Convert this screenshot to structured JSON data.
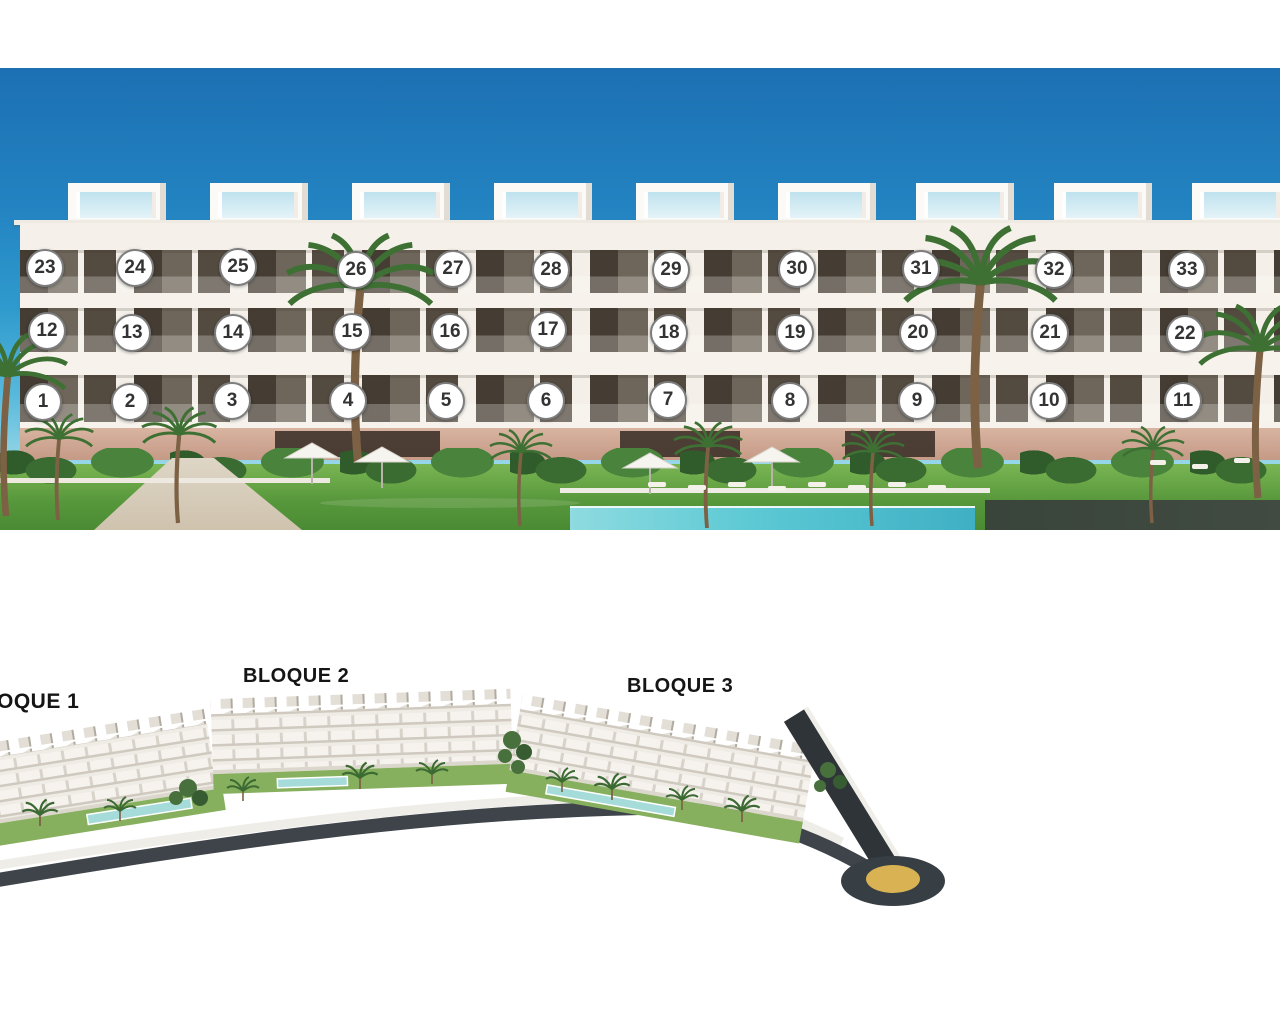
{
  "front_view": {
    "unit_markers": [
      {
        "n": "1",
        "x": 43,
        "y": 402
      },
      {
        "n": "2",
        "x": 130,
        "y": 402
      },
      {
        "n": "3",
        "x": 232,
        "y": 401
      },
      {
        "n": "4",
        "x": 348,
        "y": 401
      },
      {
        "n": "5",
        "x": 446,
        "y": 401
      },
      {
        "n": "6",
        "x": 546,
        "y": 401
      },
      {
        "n": "7",
        "x": 668,
        "y": 400
      },
      {
        "n": "8",
        "x": 790,
        "y": 401
      },
      {
        "n": "9",
        "x": 917,
        "y": 401
      },
      {
        "n": "10",
        "x": 1049,
        "y": 401
      },
      {
        "n": "11",
        "x": 1183,
        "y": 401
      },
      {
        "n": "12",
        "x": 47,
        "y": 331
      },
      {
        "n": "13",
        "x": 132,
        "y": 333
      },
      {
        "n": "14",
        "x": 233,
        "y": 333
      },
      {
        "n": "15",
        "x": 352,
        "y": 332
      },
      {
        "n": "16",
        "x": 450,
        "y": 332
      },
      {
        "n": "17",
        "x": 548,
        "y": 330
      },
      {
        "n": "18",
        "x": 669,
        "y": 333
      },
      {
        "n": "19",
        "x": 795,
        "y": 333
      },
      {
        "n": "20",
        "x": 918,
        "y": 333
      },
      {
        "n": "21",
        "x": 1050,
        "y": 333
      },
      {
        "n": "22",
        "x": 1185,
        "y": 334
      },
      {
        "n": "23",
        "x": 45,
        "y": 268
      },
      {
        "n": "24",
        "x": 135,
        "y": 268
      },
      {
        "n": "25",
        "x": 238,
        "y": 267
      },
      {
        "n": "26",
        "x": 356,
        "y": 270
      },
      {
        "n": "27",
        "x": 453,
        "y": 269
      },
      {
        "n": "28",
        "x": 551,
        "y": 270
      },
      {
        "n": "29",
        "x": 671,
        "y": 270
      },
      {
        "n": "30",
        "x": 797,
        "y": 269
      },
      {
        "n": "31",
        "x": 921,
        "y": 269
      },
      {
        "n": "32",
        "x": 1054,
        "y": 270
      },
      {
        "n": "33",
        "x": 1187,
        "y": 270
      }
    ]
  },
  "site_plan": {
    "labels": [
      {
        "text": "BLOQUE 1"
      },
      {
        "text": "BLOQUE 2"
      },
      {
        "text": "BLOQUE 3"
      }
    ]
  },
  "colors": {
    "sky_top": "#1c70b3",
    "sky_light": "#8fd4e6",
    "facade": "#f5f1ea",
    "ground_floor": "#cda18c",
    "grass": "#5f9c40",
    "pool": "#5fc9d4",
    "road": "#3e4449",
    "roundabout_center": "#d9b253",
    "marker_border": "#7d7d7d",
    "marker_text": "#333333"
  }
}
